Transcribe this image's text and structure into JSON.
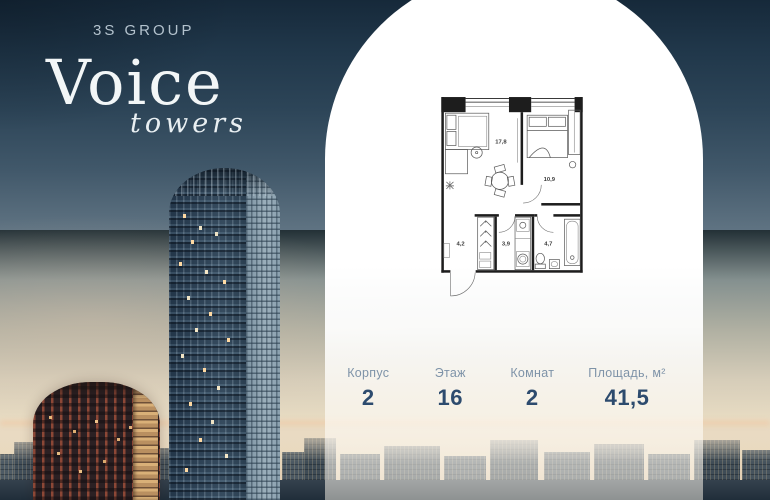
{
  "brand": {
    "developer": "3S GROUP",
    "name": "Voice",
    "subname": "towers"
  },
  "plan": {
    "rooms": [
      {
        "id": "living-room",
        "area": "17,8"
      },
      {
        "id": "bedroom",
        "area": "10,9"
      },
      {
        "id": "hallway",
        "area": "4,2"
      },
      {
        "id": "storage",
        "area": "3,9"
      },
      {
        "id": "bathroom",
        "area": "4,7"
      }
    ]
  },
  "stats": {
    "items": [
      {
        "label": "Корпус",
        "value": "2"
      },
      {
        "label": "Этаж",
        "value": "16"
      },
      {
        "label": "Комнат",
        "value": "2"
      },
      {
        "label": "Площадь, м²",
        "value": "41,5"
      }
    ]
  },
  "colors": {
    "sky_top": "#16293a",
    "sunset": "#e8dcc3",
    "panel": "#ffffff",
    "stat_label": "#7e93a8",
    "stat_value": "#2d4b6e"
  }
}
